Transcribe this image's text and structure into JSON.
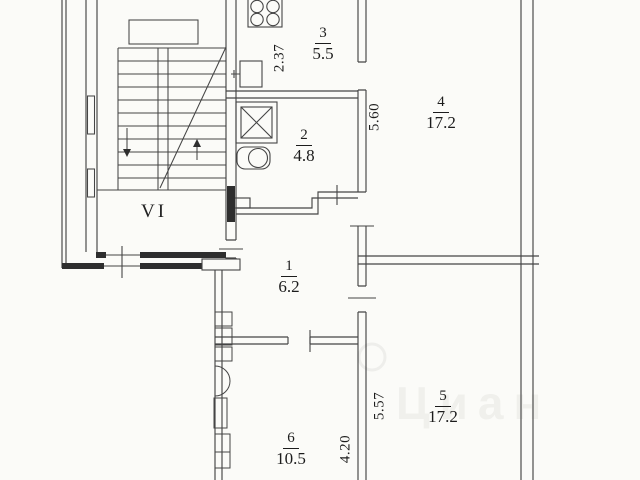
{
  "plan_type": "apartment-floor-plan",
  "colors": {
    "background": "#fbfbf8",
    "line": "#454545",
    "wall_fill": "#2e2e2e",
    "text": "#1c1c1c",
    "watermark": "rgba(95,95,85,0.07)"
  },
  "stairwell": {
    "label": "VI",
    "top_partial_text": "2.64"
  },
  "rooms": [
    {
      "number": "3",
      "area": "5.5"
    },
    {
      "number": "2",
      "area": "4.8"
    },
    {
      "number": "4",
      "area": "17.2"
    },
    {
      "number": "1",
      "area": "6.2"
    },
    {
      "number": "6",
      "area": "10.5"
    },
    {
      "number": "5",
      "area": "17.2"
    }
  ],
  "dimensions": [
    {
      "value": "2.37",
      "orientation": "vertical"
    },
    {
      "value": "5.60",
      "orientation": "vertical"
    },
    {
      "value": "5.57",
      "orientation": "vertical"
    },
    {
      "value": "4.20",
      "orientation": "vertical"
    }
  ],
  "fixtures": [
    "stove-icon",
    "sink-icon",
    "shower-icon",
    "toilet-icon"
  ],
  "watermark": {
    "text": "Циан"
  }
}
